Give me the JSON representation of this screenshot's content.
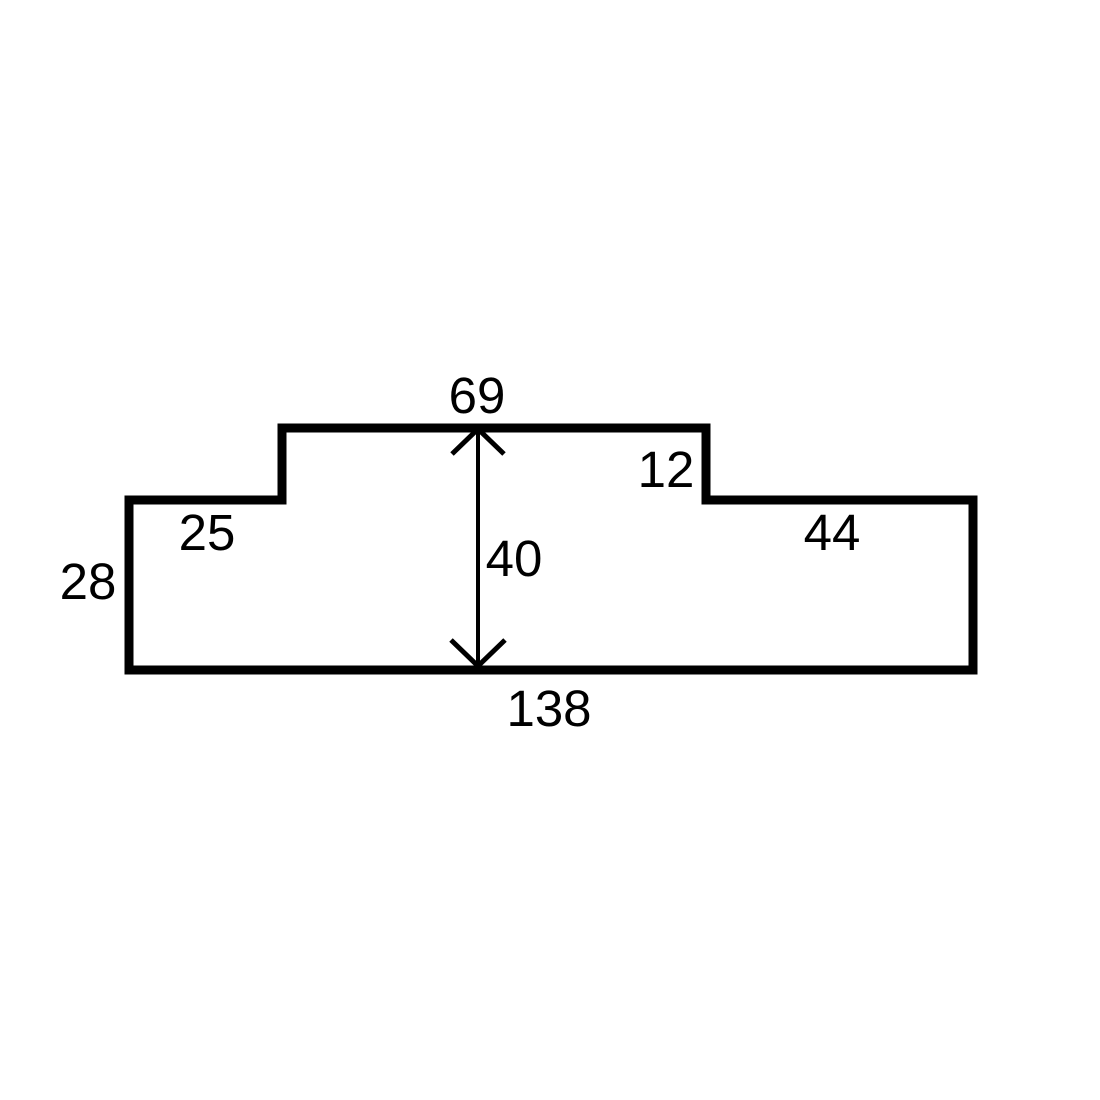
{
  "figure": {
    "type": "dimensioned-stepped-polygon",
    "background_color": "#ffffff",
    "line_color": "#000000",
    "labels": {
      "top_width": "69",
      "right_step_height": "12",
      "left_shoulder_width": "25",
      "right_shoulder_width": "44",
      "left_side_height": "28",
      "center_height": "40",
      "bottom_width": "138"
    }
  }
}
